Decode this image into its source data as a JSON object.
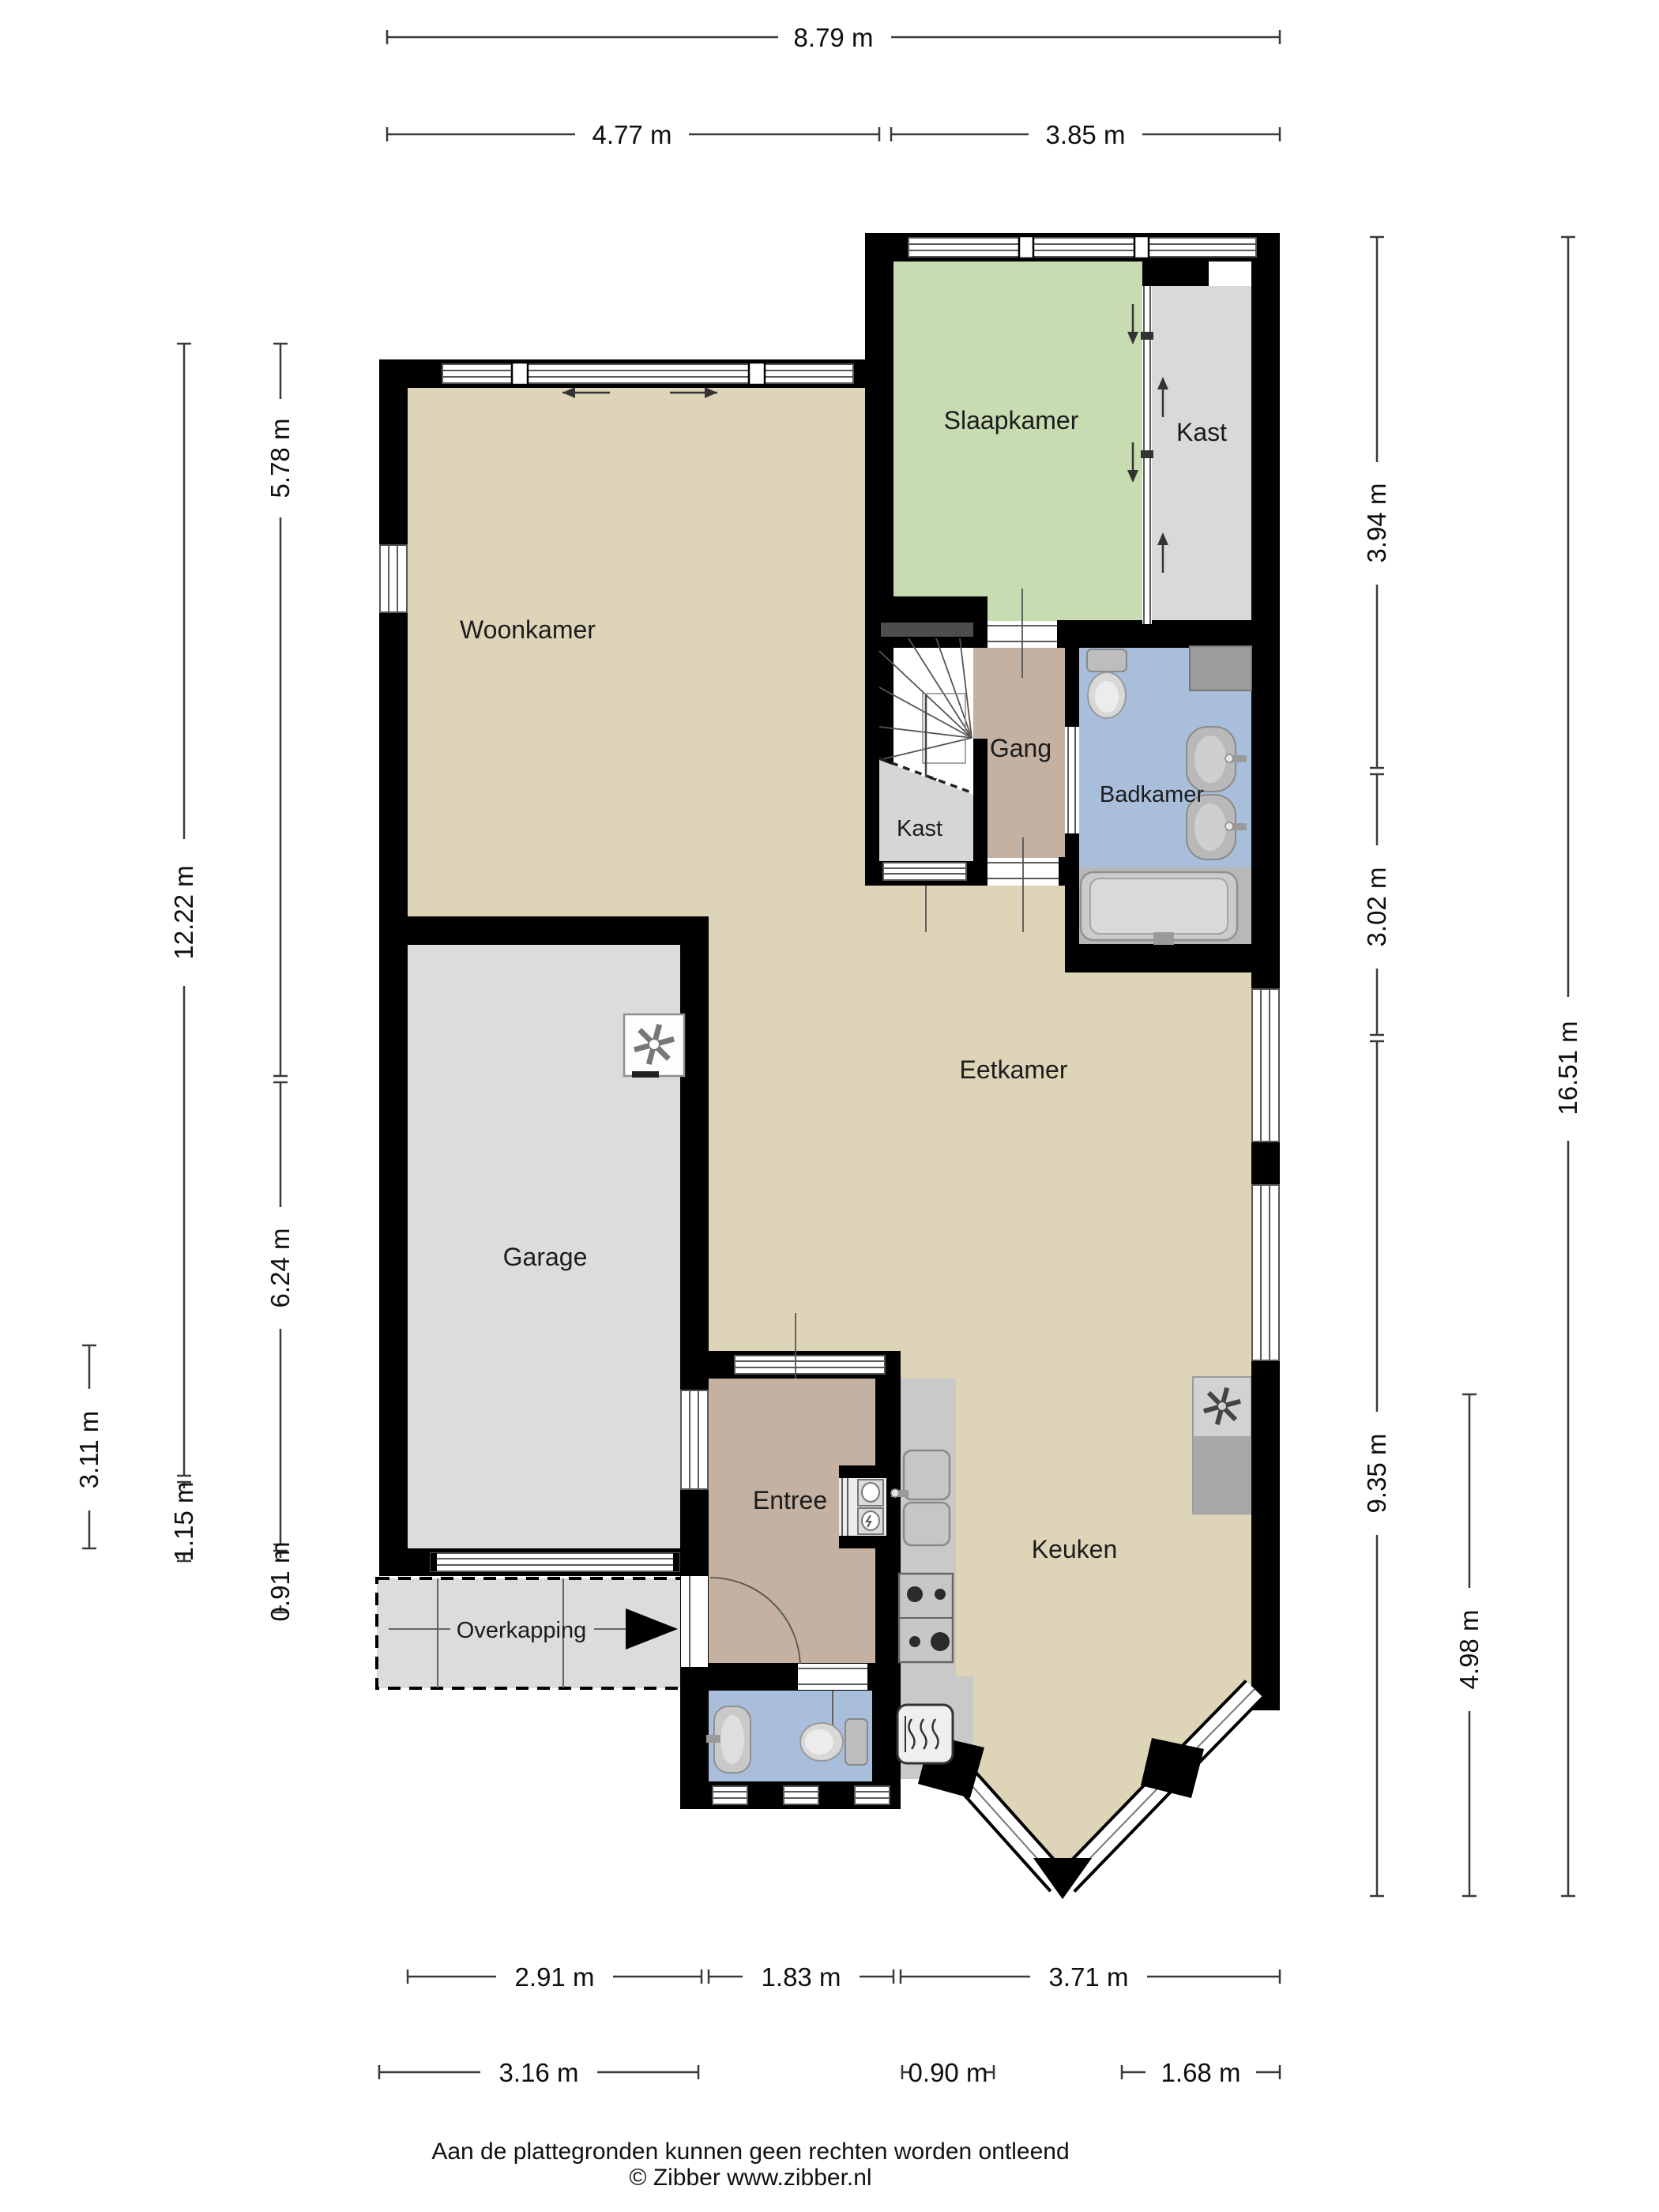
{
  "rooms": {
    "woonkamer": "Woonkamer",
    "slaapkamer": "Slaapkamer",
    "kast_slaapkamer": "Kast",
    "gang": "Gang",
    "badkamer": "Badkamer",
    "kast_trap": "Kast",
    "eetkamer": "Eetkamer",
    "garage": "Garage",
    "entree": "Entree",
    "keuken": "Keuken",
    "overkapping": "Overkapping"
  },
  "dimensions": {
    "top_total": "8.79 m",
    "top_left": "4.77 m",
    "top_right": "3.85 m",
    "left_woonkamer": "5.78 m",
    "left_total": "12.22 m",
    "left_garage": "6.24 m",
    "left_carport_depth": "3.11 m",
    "left_carport": "1.15 m",
    "left_small": "0.91 m",
    "right_slaapkamer": "3.94 m",
    "right_badkamer": "3.02 m",
    "right_total": "16.51 m",
    "right_eetkamer": "9.35 m",
    "right_keuken": "4.98 m",
    "bottom_garage": "2.91 m",
    "bottom_entree": "1.83 m",
    "bottom_keuken": "3.71 m",
    "bottom_garage_outer": "3.16 m",
    "bottom_small": "0.90 m",
    "bottom_bay": "1.68 m"
  },
  "footer": {
    "line1": "Aan de plattegronden kunnen geen rechten worden ontleend",
    "line2": "© Zibber www.zibber.nl"
  },
  "colors": {
    "floor_living": "#ded5b8",
    "floor_bedroom": "#c8dcb2",
    "floor_hall": "#c4b1a1",
    "floor_bath": "#a9bedb",
    "floor_bath_tiles": "#b8b8b8",
    "floor_garage": "#dcdcdc",
    "floor_closet": "#d9d9d9",
    "floor_carport": "#dcdcdc",
    "counter": "#c9c9c9",
    "wall": "#000000"
  }
}
